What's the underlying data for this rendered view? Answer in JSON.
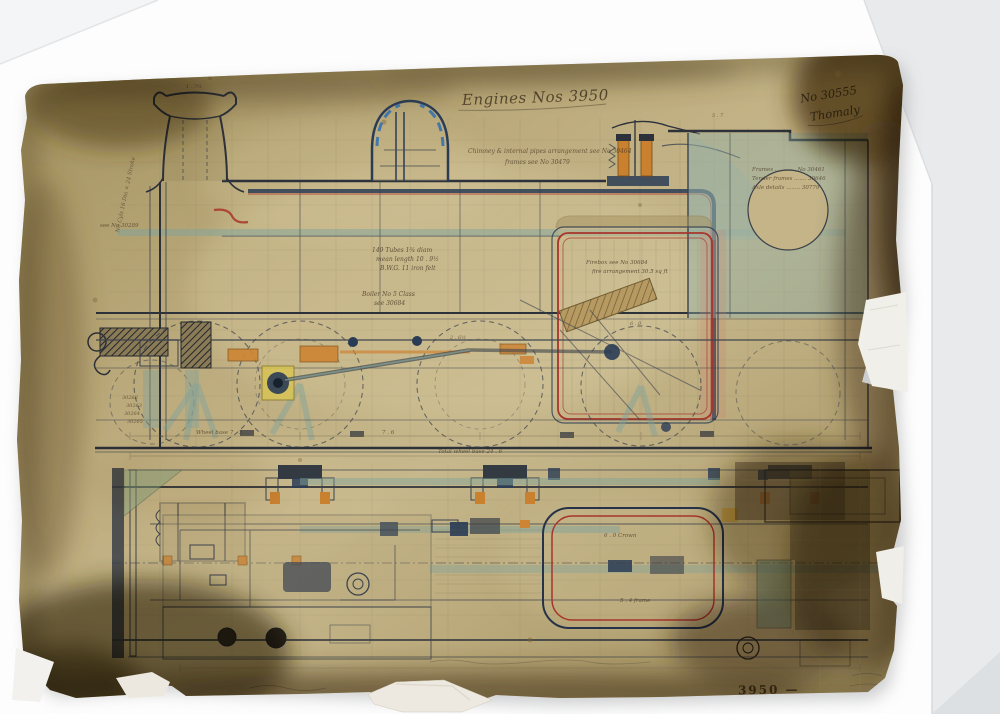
{
  "artwork": {
    "medium": "antique-locomotive-engineering-drawing-print",
    "title": "Engines Nos 3950",
    "drawing_no": "No 30555",
    "signature": "Thomaly",
    "stamp": "3950 —",
    "palette": {
      "paper_tan": "#bfae80",
      "stain_brown": "#4a3414",
      "ink": "#2c313a",
      "firebox_red": "#a8352c",
      "pipe_navy": "#2a3c55",
      "wash_teal": "#7fa39b",
      "brass_orange": "#cd8434",
      "axlebox_yellow": "#d8c455",
      "mount_white": "#fdfdfd"
    },
    "notes": {
      "arrangement_1": "Chimney & internal pipes arrangement see No 30464",
      "arrangement_2": "frames see No 30479",
      "ref_1": "Frames ............ No 30461",
      "ref_2": "Tender frames ....... 30646",
      "ref_3": "Axle details ........ 30779",
      "tubes_1": "149 Tubes 1¾ diam",
      "tubes_2": "mean length 10 . 9½",
      "tubes_3": "B.W.G. 11 iron felt",
      "boiler_1": "Boiler No 5 Class",
      "boiler_2": "see 30684",
      "firebox_1": "Firebox see No 30684",
      "firebox_2": "fire arrangement 30.5 sq ft",
      "cylinders": "No Cyls 16 Dia × 24 Stroke",
      "see_ref": "see No 30289",
      "parts_1": "30262",
      "parts_2": "30263",
      "parts_3": "30264",
      "parts_4": "30265",
      "dim_a": "1 . 7½",
      "dim_b": "5 . 7",
      "dim_c": "2 . 6½",
      "dim_d": "6 . 0",
      "wheelbase_1": "Wheel base 7 . 3",
      "wheelbase_2": "7 . 6",
      "wheelbase_3": "Total wheel base 24 . 6",
      "plan_crown": "6 . 0 Crown",
      "plan_base": "5 . 4 frame"
    }
  }
}
